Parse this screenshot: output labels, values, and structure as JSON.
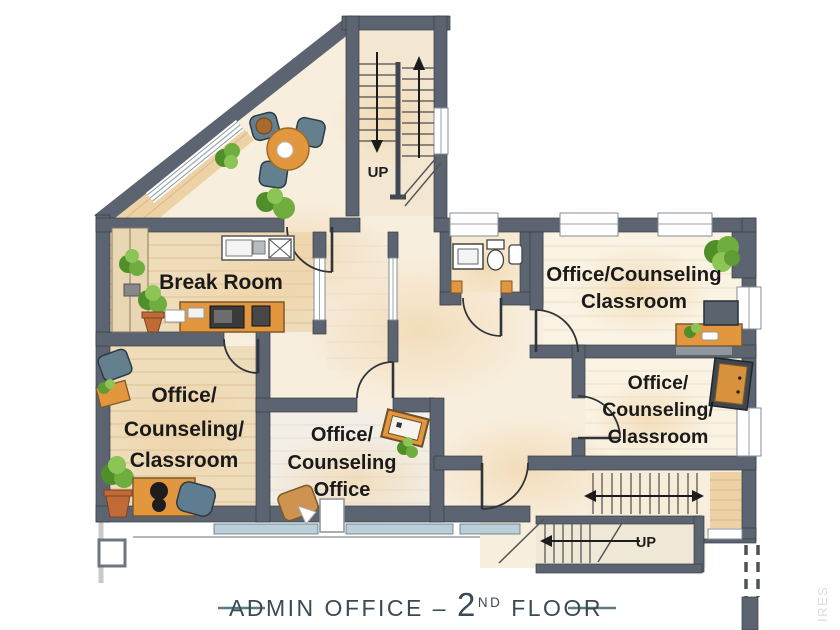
{
  "plan": {
    "title": {
      "main": "ADMIN OFFICE",
      "separator": "–",
      "floor_number": "2",
      "floor_ordinal": "ND",
      "floor_word": "FLOOR"
    },
    "watermark": "IRES"
  },
  "rooms": {
    "break_room": {
      "label": "Break Room"
    },
    "office_counseling_classroom_west": {
      "line1": "Office/",
      "line2": "Counseling/",
      "line3": "Classroom"
    },
    "office_counseling_office": {
      "line1": "Office/",
      "line2": "Counseling",
      "line3": "Office"
    },
    "office_counseling_classroom_northeast": {
      "line1": "Office/Counseling",
      "line2": "Classroom"
    },
    "office_counseling_classroom_east": {
      "line1": "Office/",
      "line2": "Counseling/",
      "line3": "Classroom"
    }
  },
  "stairs": {
    "north_stairwell": {
      "direction_label": "UP"
    },
    "south_stairwell": {
      "direction_label": "UP"
    }
  },
  "colors": {
    "wall": "#5b6470",
    "wall_outline": "#363d45",
    "floor_cream": "#f8eedd",
    "floor_wood": "#efdcba",
    "floor_light": "#f3efe7",
    "accent_wood": "#e2973f",
    "chair_blue": "#5f7d90",
    "plant_green": "#61a437",
    "pot_terracotta": "#c06a38",
    "window_glass": "#b9cfda",
    "title_text": "#3a4a55",
    "dash_teal": "#5a7a85"
  }
}
